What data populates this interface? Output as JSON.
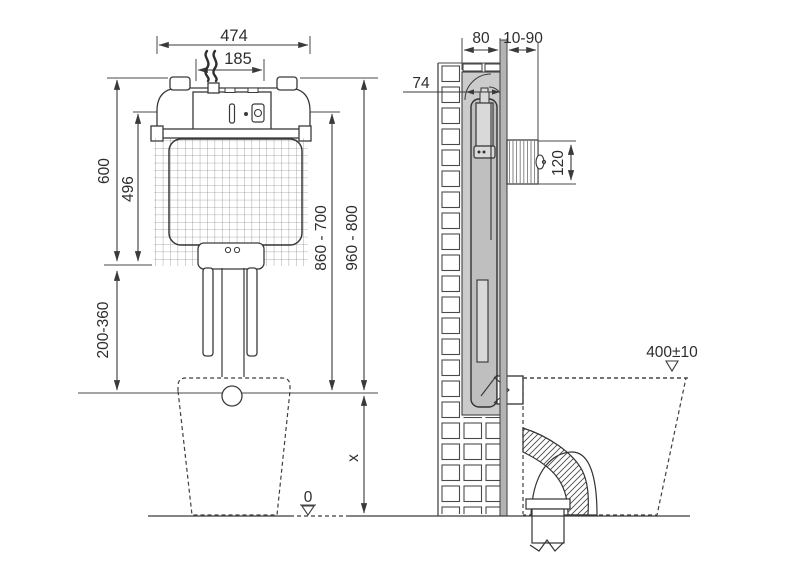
{
  "drawing_title": "concealed cistern installation dimensions",
  "front_view": {
    "name": "front elevation",
    "dimensions": {
      "overall_width": "474",
      "inlet_width": "185",
      "frame_height": "600",
      "tank_height": "496",
      "flush_pipe_adjust": "200-360",
      "panel_height_range": "860 - 700",
      "frame_top_range": "960 - 800",
      "bowl_height_var": "x",
      "floor_level": "0"
    }
  },
  "side_view": {
    "name": "side section",
    "dimensions": {
      "niche_depth": "80",
      "finish_thickness": "10-90",
      "cistern_depth": "74",
      "flush_plate_height": "120",
      "seat_height": "400±10"
    }
  },
  "icons": {
    "water_supply_icon": "wavy-water-lines",
    "datum_triangle_icon": "open-triangle-down"
  },
  "colors": {
    "line": "#3a3a3a",
    "niche_fill": "#cbcbcb",
    "tank_fill": "#bfbfbf",
    "valve_fill": "#d9d9d9",
    "wall_finish_fill": "#b3b3b3",
    "background": "#ffffff"
  }
}
